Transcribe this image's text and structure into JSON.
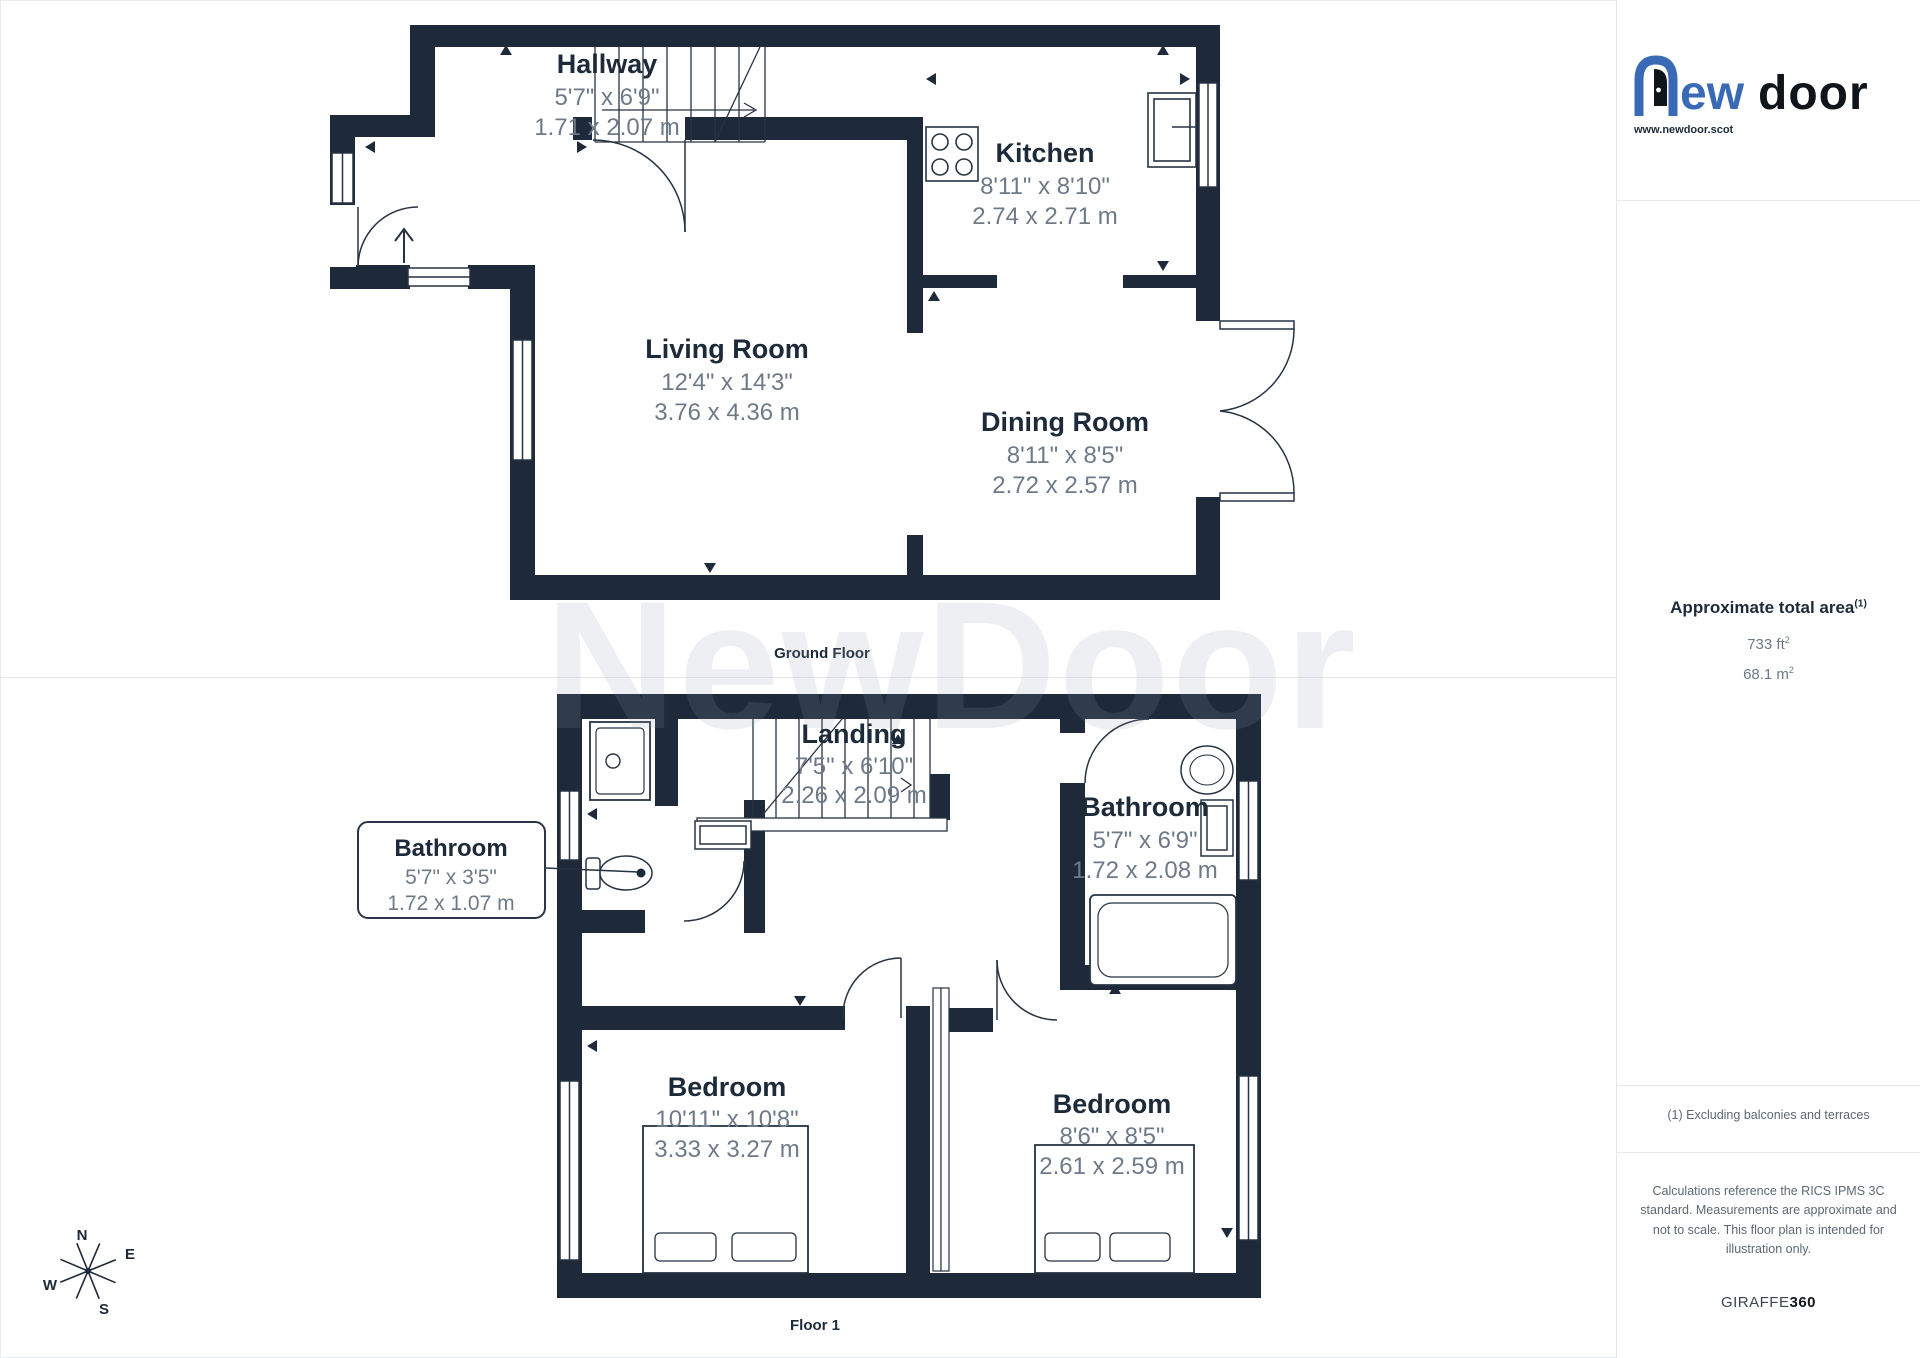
{
  "logo": {
    "brand_rest": "ew",
    "brand_second": "door",
    "website": "www.newdoor.scot"
  },
  "sidebar": {
    "area_title": "Approximate total area",
    "area_sup": "(1)",
    "area_ft_value": "733 ft",
    "area_ft_sup": "2",
    "area_m_value": "68.1 m",
    "area_m_sup": "2",
    "footnote": "(1) Excluding balconies and terraces",
    "disclaimer": "Calculations reference the RICS IPMS 3C standard. Measurements are approximate and not to scale. This floor plan is intended for illustration only.",
    "brand_giraffe": "GIRAFFE",
    "brand_360": "360"
  },
  "floors": [
    {
      "caption": "Ground Floor",
      "rooms": [
        {
          "name": "Hallway",
          "imperial": "5'7\" x 6'9\"",
          "metric": "1.71 x 2.07 m"
        },
        {
          "name": "Kitchen",
          "imperial": "8'11\" x 8'10\"",
          "metric": "2.74 x 2.71 m"
        },
        {
          "name": "Living Room",
          "imperial": "12'4\" x 14'3\"",
          "metric": "3.76 x 4.36 m"
        },
        {
          "name": "Dining Room",
          "imperial": "8'11\" x 8'5\"",
          "metric": "2.72 x 2.57 m"
        }
      ]
    },
    {
      "caption": "Floor 1",
      "rooms": [
        {
          "name": "Landing",
          "imperial": "7'5\" x 6'10\"",
          "metric": "2.26 x 2.09 m"
        },
        {
          "name": "Bathroom",
          "imperial": "5'7\" x 3'5\"",
          "metric": "1.72 x 1.07 m"
        },
        {
          "name": "Bathroom",
          "imperial": "5'7\" x 6'9\"",
          "metric": "1.72 x 2.08 m"
        },
        {
          "name": "Bedroom",
          "imperial": "10'11\" x 10'8\"",
          "metric": "3.33 x 3.27 m"
        },
        {
          "name": "Bedroom",
          "imperial": "8'6\" x 8'5\"",
          "metric": "2.61 x 2.59 m"
        }
      ]
    }
  ],
  "compass": {
    "n": "N",
    "e": "E",
    "s": "S",
    "w": "W"
  },
  "watermark": "NewDoor",
  "colors": {
    "wall": "#1e2a3a",
    "line": "#273343",
    "label": "#1d2a39",
    "dims": "#6e7a88",
    "logo_blue": "#3a6ab5"
  }
}
